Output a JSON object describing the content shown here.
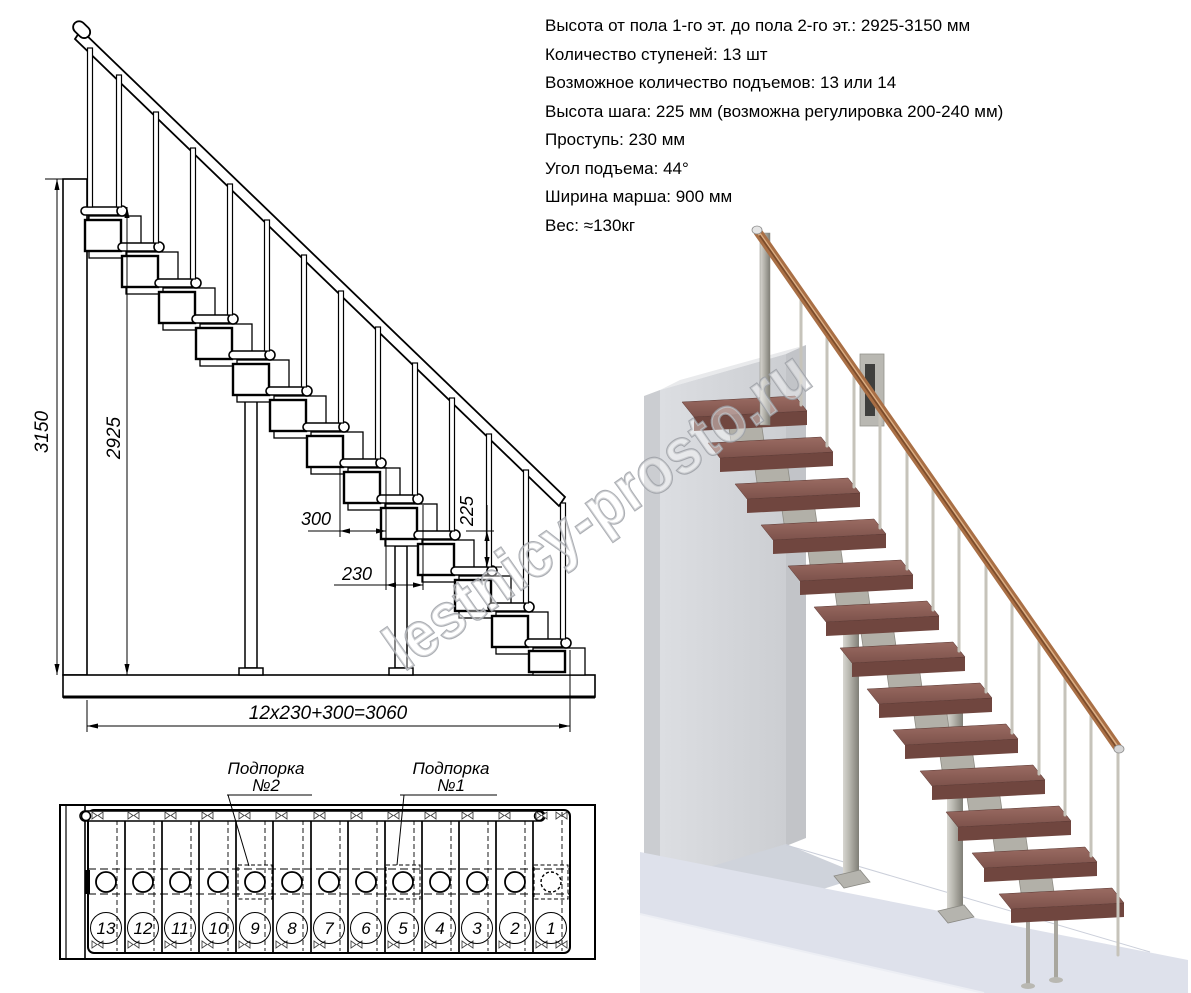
{
  "specs": {
    "lines": [
      "Высота от пола 1-го эт. до пола 2-го эт.: 2925-3150 мм",
      "Количество ступеней: 13 шт",
      "Возможное количество подъемов: 13 или 14",
      "Высота шага: 225 мм (возможна регулировка 200-240 мм)",
      "Проступь: 230 мм",
      "Угол подъема: 44°",
      "Ширина марша: 900 мм",
      "Вес: ≈130кг"
    ]
  },
  "elevation": {
    "dim_total_height": "3150",
    "dim_tread_height": "2925",
    "dim_tread_length": "300",
    "dim_step_run": "230",
    "dim_step_rise": "225",
    "dim_total_length": "12x230+300=3060"
  },
  "plan": {
    "support2": {
      "line1": "Подпорка",
      "line2": "№2"
    },
    "support1": {
      "line1": "Подпорка",
      "line2": "№1"
    },
    "steps": [
      "13",
      "12",
      "11",
      "10",
      "9",
      "8",
      "7",
      "6",
      "5",
      "4",
      "3",
      "2",
      "1"
    ]
  },
  "watermark": {
    "text": "lestnicy-prosto.ru"
  },
  "colors": {
    "tread_brown": "#8c5f58",
    "rail_copper": "#a96f45",
    "metal_gray": "#b2b0a8",
    "wall_gray": "#d6d8dc",
    "line_black": "#000000"
  }
}
